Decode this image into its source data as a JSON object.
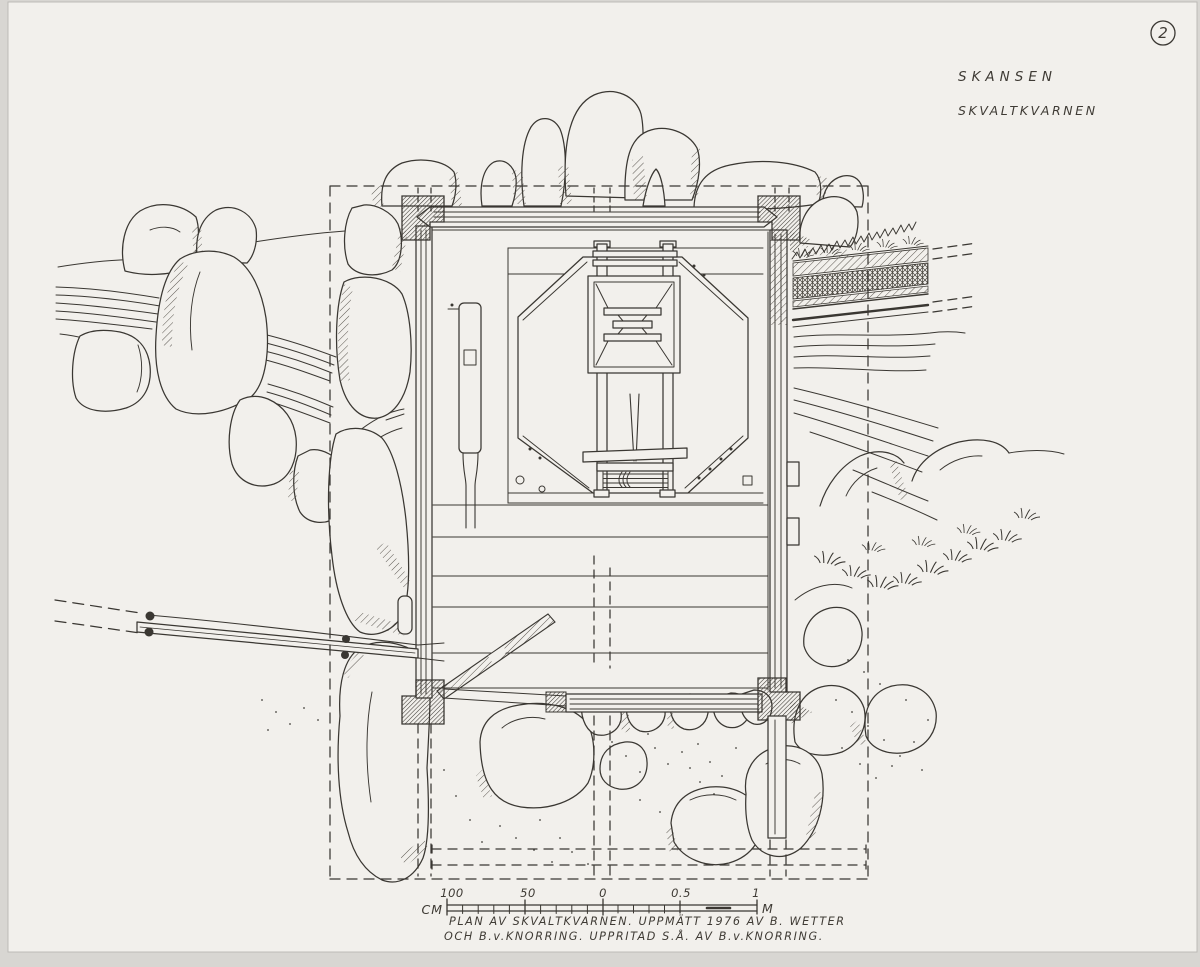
{
  "sheet": {
    "number": "2",
    "site": "SKANSEN",
    "subject": "SKVALTKVARNEN"
  },
  "scale_bar": {
    "unit_left": "CM",
    "unit_right": "M",
    "tick_labels": [
      "100",
      "50",
      "0",
      "0.5",
      "1"
    ]
  },
  "caption": {
    "line1": "PLAN AV SKVALTKVARNEN. UPPMÄTT 1976 AV B. WETTER",
    "line2": "OCH B.v.KNORRING. UPPRITAD S.Å. AV B.v.KNORRING."
  },
  "colors": {
    "ink": "#3a3732",
    "paper": "#f2f0ec",
    "scan_bed": "#d8d6d2"
  }
}
